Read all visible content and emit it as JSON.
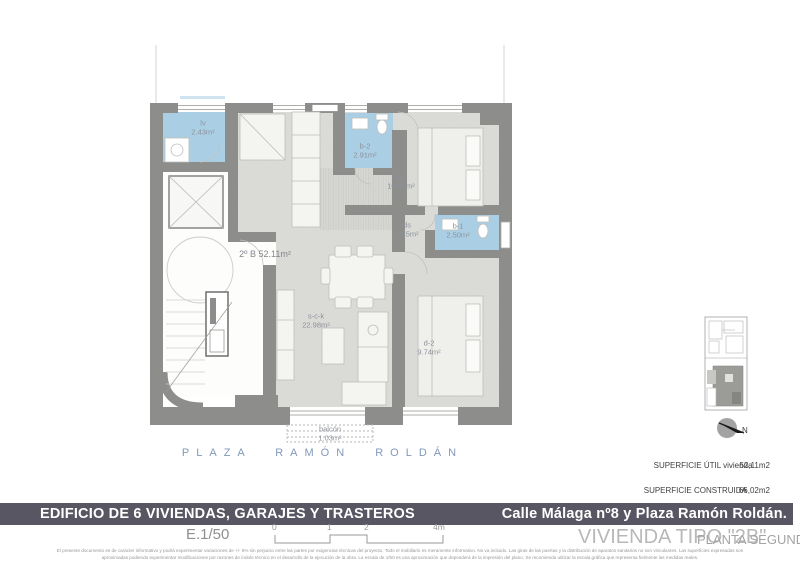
{
  "plan": {
    "rooms": [
      {
        "name": "lv",
        "area": "2.43m²"
      },
      {
        "name": "b-2",
        "area": "2.91m²"
      },
      {
        "name": "d-1",
        "area": "10.00m²"
      },
      {
        "name": "ds",
        "area": "1.45m²"
      },
      {
        "name": "b-1",
        "area": "2.50m²"
      },
      {
        "name": "s-c-k",
        "area": "22.98m²"
      },
      {
        "name": "d-2",
        "area": "9.74m²"
      },
      {
        "name": "balcón",
        "area": "1.03m²"
      }
    ],
    "unit": {
      "name": "2º B",
      "area": "52.11m²"
    },
    "street_label": "PLAZA RAMÓN ROLDÁN",
    "north_label": "N",
    "colors": {
      "wall": "#8d8d8b",
      "wet_room": "#aacfe4",
      "floor": "#dcdcd8",
      "street_text": "#8298bb"
    }
  },
  "summary": {
    "util_label": "SUPERFICIE ÚTIL vivienda",
    "util_value": "52,11m2",
    "built_label": "SUPERFICIE CONSTRUIDA",
    "built_value": "66,02m2"
  },
  "banner": {
    "left": "EDIFICIO DE 6 VIVIENDAS, GARAJES Y TRASTEROS",
    "right": "Calle Málaga nº8 y Plaza Ramón Roldán.",
    "background": "#585663"
  },
  "footer": {
    "scale_label": "E.1/50",
    "scale_ticks": [
      "0",
      "1",
      "2",
      "4m"
    ],
    "unit_title": "VIVIENDA TIPO \"2B\"",
    "floor_title": "PLANTA SEGUNDA",
    "disclaimer_line1": "El presente documento es de carácter informativo y podrá experimentar variaciones de +/- 5% sin perjuicio entre las partes por exigencias técnicas del proyecto. Todo el mobiliario es meramente informativo. No va incluido. Las giras de las puertas y la distribución de aparatos sanitarios no son vinculantes. Las superficies expresadas son",
    "disclaimer_line2": "aproximadas pudiendo experimentar modificaciones por razones de índole técnico en el desarrollo de la ejecución de la obra. La escala de 1/50 es una aproximación que dependerá de la impresión del plano. Se recomienda utilizar la escala gráfica que representa fielmente las medidas reales."
  }
}
